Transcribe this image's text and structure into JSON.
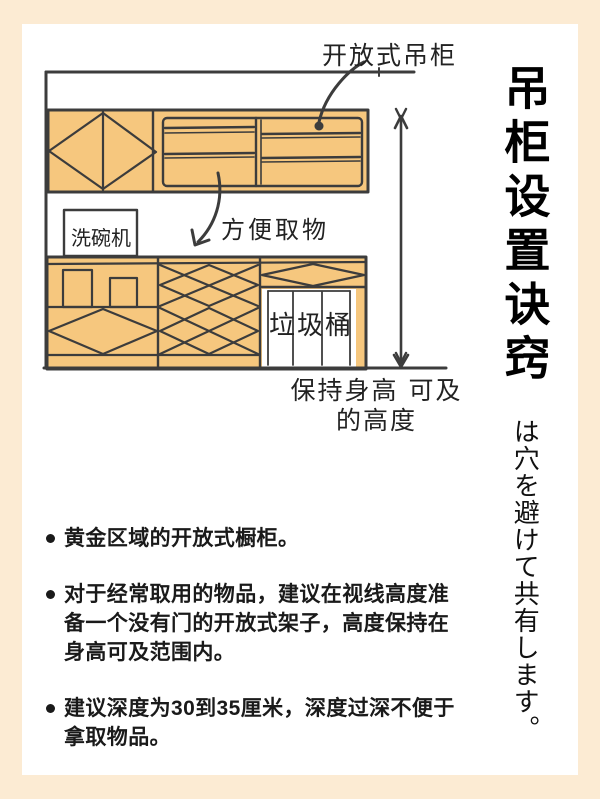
{
  "colors": {
    "page_bg": "#FCEBD3",
    "panel_bg": "#FFFFFF",
    "cabinet_fill": "#F6C77E",
    "line": "#3C3C3C",
    "text": "#1A1A1A"
  },
  "illustration": {
    "labels": {
      "open_cabinet": "开放式吊柜",
      "easy_reach": "方便取物",
      "dishwasher": "洗碗机",
      "trash_bin": "垃圾桶",
      "height_note": "保持身高 可及的高度"
    }
  },
  "sidebar": {
    "title": "吊柜设置诀窍",
    "subtitle": "は穴を避けて共有します。"
  },
  "bullets": [
    "黄金区域的开放式橱柜。",
    "对于经常取用的物品，建议在视线高度准备一个没有门的开放式架子，高度保持在身高可及范围内。",
    "建议深度为30到35厘米，深度过深不便于拿取物品。"
  ]
}
